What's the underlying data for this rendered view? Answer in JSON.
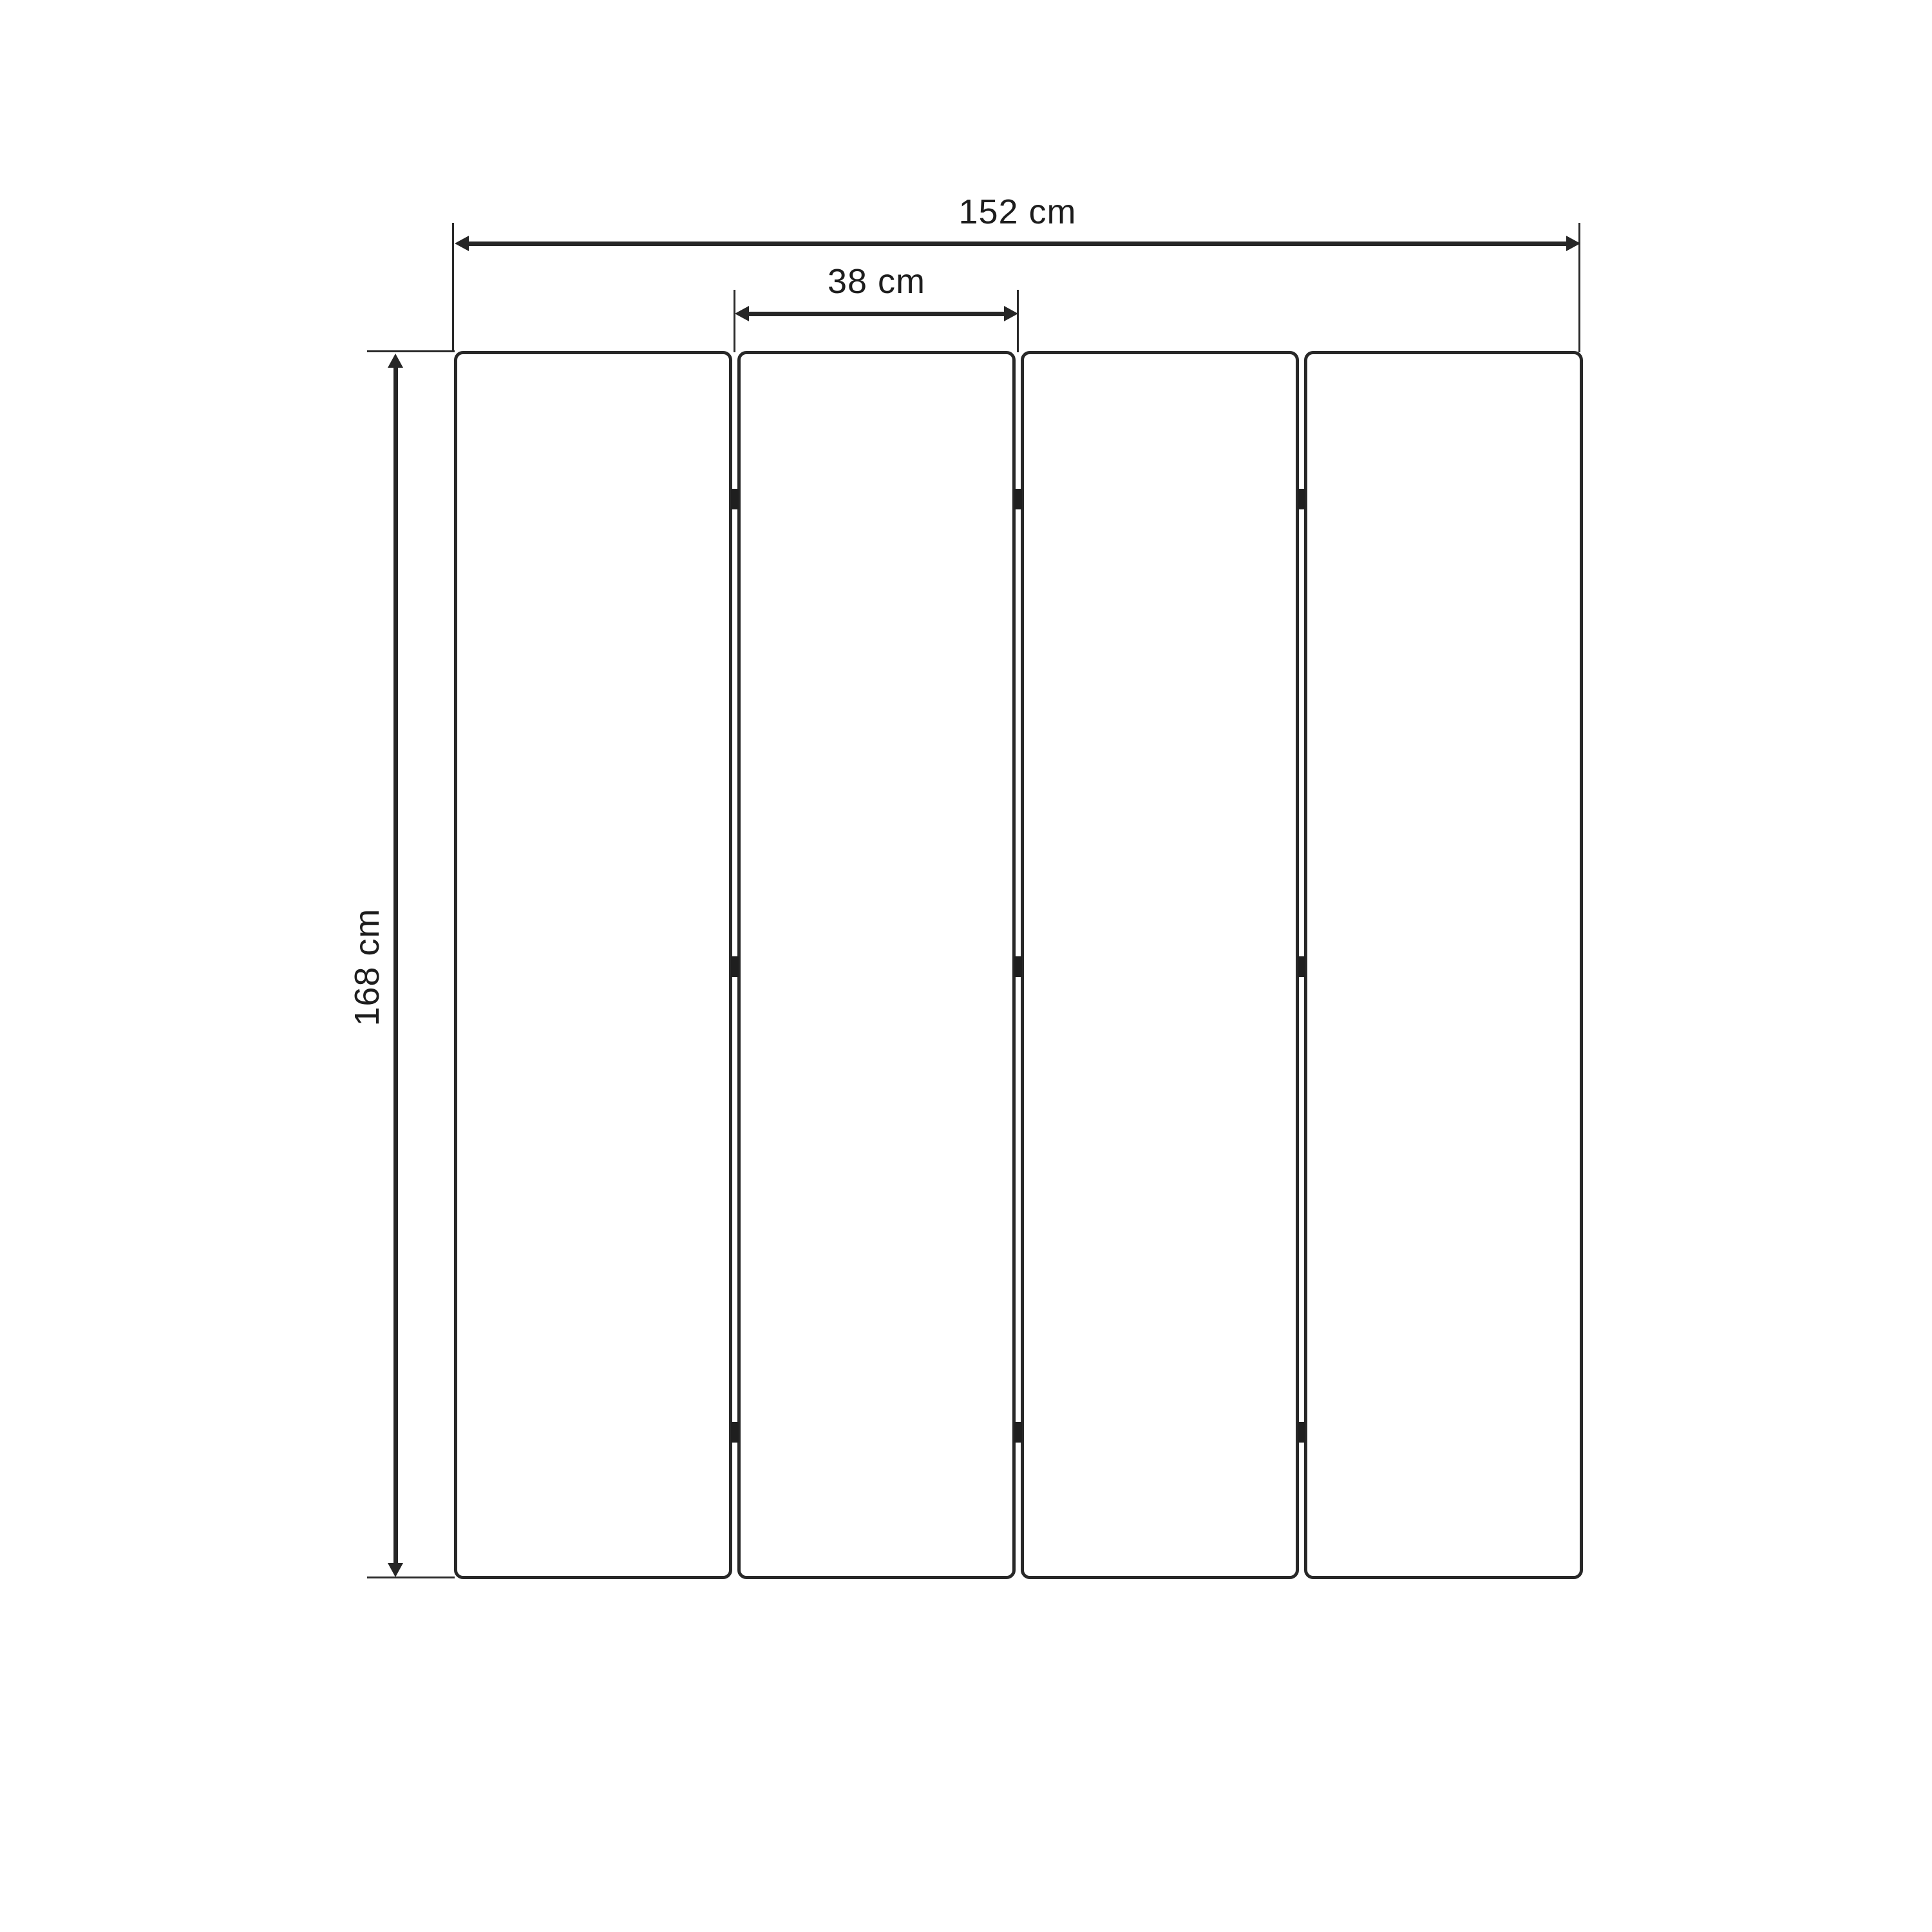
{
  "diagram": {
    "panels": {
      "count": 4,
      "hinge_rows": 3
    },
    "dimensions": {
      "total_width": "152 cm",
      "panel_width": "38 cm",
      "height": "168 cm"
    },
    "colors": {
      "background": "#ffffff",
      "panel_fill": "#ffffff",
      "line": "#262626",
      "hinge": "#1f1f1f",
      "text": "#1d1d1d"
    }
  }
}
